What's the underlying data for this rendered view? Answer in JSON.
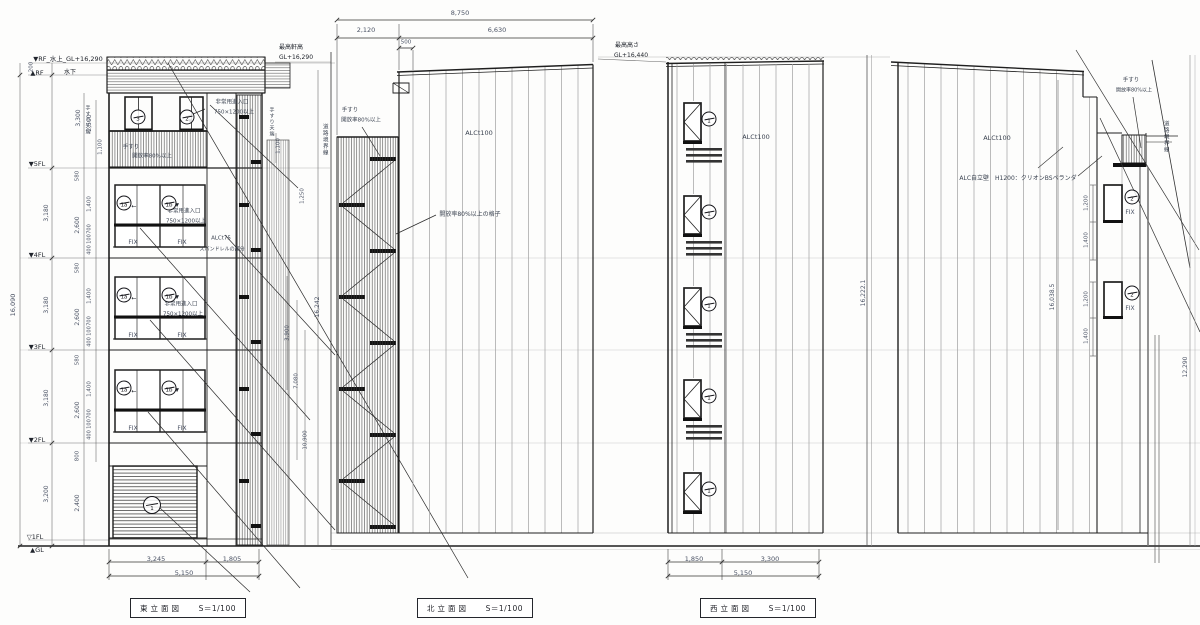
{
  "palette": {
    "line": "#1f1f1f",
    "dim": "#4a5264",
    "note": "#3a4250",
    "label": "#20242c"
  },
  "titles": {
    "east": {
      "name": "東立面図",
      "scale": "S＝1/100"
    },
    "north": {
      "name": "北立面図",
      "scale": "S＝1/100"
    },
    "west": {
      "name": "西立面図",
      "scale": "S＝1/100"
    }
  },
  "window_marks": [
    {
      "x": 138,
      "y": 117,
      "t": "3"
    },
    {
      "x": 187,
      "y": 117,
      "t": "2"
    },
    {
      "x": 124,
      "y": 203,
      "t": "1a"
    },
    {
      "x": 169,
      "y": 203,
      "t": "1b"
    },
    {
      "x": 124,
      "y": 295,
      "t": "1a"
    },
    {
      "x": 169,
      "y": 295,
      "t": "1b"
    },
    {
      "x": 124,
      "y": 388,
      "t": "1a"
    },
    {
      "x": 169,
      "y": 388,
      "t": "1b"
    },
    {
      "x": 152,
      "y": 505,
      "t": "1",
      "d": 18
    },
    {
      "x": 709,
      "y": 119,
      "t": "1"
    },
    {
      "x": 709,
      "y": 212,
      "t": "1"
    },
    {
      "x": 709,
      "y": 304,
      "t": "1"
    },
    {
      "x": 709,
      "y": 396,
      "t": "1"
    },
    {
      "x": 709,
      "y": 489,
      "t": "1"
    },
    {
      "x": 1132,
      "y": 197,
      "t": "2"
    },
    {
      "x": 1132,
      "y": 293,
      "t": "2"
    }
  ],
  "annotations": [
    {
      "n": "level-rf-top",
      "x": 68,
      "y": 59,
      "t": "▼RF_水上_GL+16,290",
      "s": 6.5,
      "c": "label"
    },
    {
      "n": "level-rf",
      "x": 37,
      "y": 73,
      "t": "▲RF",
      "s": 6.5,
      "c": "label"
    },
    {
      "n": "level-rf-lower",
      "x": 70,
      "y": 73,
      "t": "水下",
      "s": 6,
      "c": "label"
    },
    {
      "n": "level-5fl",
      "x": 37,
      "y": 164,
      "t": "▼5FL",
      "s": 6.5,
      "c": "label"
    },
    {
      "n": "level-4fl",
      "x": 37,
      "y": 255,
      "t": "▼4FL",
      "s": 6.5,
      "c": "label"
    },
    {
      "n": "level-3fl",
      "x": 37,
      "y": 347,
      "t": "▼3FL",
      "s": 6.5,
      "c": "label"
    },
    {
      "n": "level-2fl",
      "x": 37,
      "y": 440,
      "t": "▼2FL",
      "s": 6.5,
      "c": "label"
    },
    {
      "n": "level-1fl",
      "x": 35,
      "y": 537,
      "t": "▽1FL",
      "s": 6.5,
      "c": "label"
    },
    {
      "n": "level-gl",
      "x": 37,
      "y": 550,
      "t": "▲GL",
      "s": 6.5,
      "c": "label"
    },
    {
      "n": "east-overall-height",
      "x": 13,
      "y": 305,
      "t": "16,090",
      "m": "r",
      "s": 6.5
    },
    {
      "x": 32,
      "y": 67,
      "t": "200",
      "m": "r",
      "s": 5.5
    },
    {
      "x": 79,
      "y": 118,
      "t": "3,300",
      "m": "r",
      "s": 6
    },
    {
      "x": 90,
      "y": 123,
      "t": "2,500",
      "m": "r",
      "s": 6
    },
    {
      "x": 101,
      "y": 147,
      "t": "1,100",
      "m": "r",
      "s": 5.5
    },
    {
      "x": 78,
      "y": 176,
      "t": "580",
      "m": "r",
      "s": 5.5
    },
    {
      "x": 47,
      "y": 213,
      "t": "3,180",
      "m": "r",
      "s": 6
    },
    {
      "x": 78,
      "y": 225,
      "t": "2,600",
      "m": "r",
      "s": 6
    },
    {
      "x": 90,
      "y": 204,
      "t": "1,400",
      "m": "r",
      "s": 5.5
    },
    {
      "x": 90,
      "y": 229,
      "t": "700",
      "m": "r",
      "s": 5
    },
    {
      "x": 90,
      "y": 239,
      "t": "100",
      "m": "r",
      "s": 5
    },
    {
      "x": 90,
      "y": 250,
      "t": "400",
      "m": "r",
      "s": 5
    },
    {
      "x": 78,
      "y": 268,
      "t": "580",
      "m": "r",
      "s": 5.5
    },
    {
      "x": 47,
      "y": 305,
      "t": "3,180",
      "m": "r",
      "s": 6
    },
    {
      "x": 78,
      "y": 317,
      "t": "2,600",
      "m": "r",
      "s": 6
    },
    {
      "x": 90,
      "y": 296,
      "t": "1,400",
      "m": "r",
      "s": 5.5
    },
    {
      "x": 90,
      "y": 321,
      "t": "700",
      "m": "r",
      "s": 5
    },
    {
      "x": 90,
      "y": 331,
      "t": "100",
      "m": "r",
      "s": 5
    },
    {
      "x": 90,
      "y": 342,
      "t": "400",
      "m": "r",
      "s": 5
    },
    {
      "x": 78,
      "y": 360,
      "t": "580",
      "m": "r",
      "s": 5.5
    },
    {
      "x": 47,
      "y": 398,
      "t": "3,180",
      "m": "r",
      "s": 6
    },
    {
      "x": 78,
      "y": 410,
      "t": "2,600",
      "m": "r",
      "s": 6
    },
    {
      "x": 90,
      "y": 389,
      "t": "1,400",
      "m": "r",
      "s": 5.5
    },
    {
      "x": 90,
      "y": 414,
      "t": "700",
      "m": "r",
      "s": 5
    },
    {
      "x": 90,
      "y": 424,
      "t": "100",
      "m": "r",
      "s": 5
    },
    {
      "x": 90,
      "y": 435,
      "t": "400",
      "m": "r",
      "s": 5
    },
    {
      "x": 78,
      "y": 456,
      "t": "800",
      "m": "r",
      "s": 5.5
    },
    {
      "x": 47,
      "y": 494,
      "t": "3,200",
      "m": "r",
      "s": 6
    },
    {
      "x": 78,
      "y": 503,
      "t": "2,400",
      "m": "r",
      "s": 6
    },
    {
      "n": "fix-label",
      "x": 133,
      "y": 243,
      "t": "FIX",
      "s": 6
    },
    {
      "n": "fix-label",
      "x": 182,
      "y": 243,
      "t": "FIX",
      "s": 6
    },
    {
      "n": "fix-label",
      "x": 133,
      "y": 336,
      "t": "FIX",
      "s": 6
    },
    {
      "n": "fix-label",
      "x": 182,
      "y": 336,
      "t": "FIX",
      "s": 6
    },
    {
      "n": "fix-label",
      "x": 133,
      "y": 429,
      "t": "FIX",
      "s": 6
    },
    {
      "n": "fix-label",
      "x": 182,
      "y": 429,
      "t": "FIX",
      "s": 6
    },
    {
      "x": 232,
      "y": 103,
      "t": "非常用進入口",
      "s": 5.5,
      "c": "note"
    },
    {
      "x": 234,
      "y": 113,
      "t": "750×1200以上",
      "s": 5.5,
      "c": "note"
    },
    {
      "x": 184,
      "y": 212,
      "t": "非常用進入口",
      "s": 5.5,
      "c": "note"
    },
    {
      "x": 186,
      "y": 222,
      "t": "750×1200以上",
      "s": 5.5,
      "c": "note"
    },
    {
      "x": 181,
      "y": 305,
      "t": "非常用進入口",
      "s": 5.5,
      "c": "note"
    },
    {
      "x": 183,
      "y": 315,
      "t": "750×1200以上",
      "s": 5.5,
      "c": "note"
    },
    {
      "x": 131,
      "y": 148,
      "t": "手すり",
      "s": 5.5,
      "c": "note"
    },
    {
      "x": 152,
      "y": 157,
      "t": "開放率80%以上",
      "s": 5.5,
      "c": "note"
    },
    {
      "x": 87,
      "y": 120,
      "t": "手すり天端",
      "m": "v",
      "s": 5,
      "c": "note"
    },
    {
      "x": 271,
      "y": 122,
      "t": "手すり天端",
      "m": "v",
      "s": 5,
      "c": "note"
    },
    {
      "x": 279,
      "y": 146,
      "t": "1,100",
      "m": "r",
      "s": 5.5
    },
    {
      "x": 221,
      "y": 239,
      "t": "ALCt75",
      "s": 5.5,
      "c": "note"
    },
    {
      "x": 222,
      "y": 250,
      "t": "スパンドレルの部分",
      "s": 5,
      "c": "note"
    },
    {
      "x": 303,
      "y": 196,
      "t": "1,250",
      "m": "r",
      "s": 5.5
    },
    {
      "x": 318,
      "y": 307,
      "t": "16,242",
      "m": "r",
      "s": 6
    },
    {
      "x": 288,
      "y": 333,
      "t": "3,900",
      "m": "r",
      "s": 5.5
    },
    {
      "x": 297,
      "y": 381,
      "t": "7,080",
      "m": "r",
      "s": 5.5
    },
    {
      "x": 306,
      "y": 440,
      "t": "10,900",
      "m": "r",
      "s": 5.5
    },
    {
      "n": "north-eave-height",
      "x": 291,
      "y": 48,
      "t": "最高軒高",
      "s": 6,
      "c": "label"
    },
    {
      "n": "north-eave-height-value",
      "x": 296,
      "y": 58,
      "t": "GL+16,290",
      "s": 6,
      "c": "label"
    },
    {
      "x": 156,
      "y": 559,
      "t": "3,245",
      "s": 6.5
    },
    {
      "x": 232,
      "y": 559,
      "t": "1,805",
      "s": 6.5
    },
    {
      "x": 184,
      "y": 573,
      "t": "5,150",
      "s": 6.5
    },
    {
      "x": 190,
      "y": 122,
      "t": "▼",
      "s": 5,
      "c": "label"
    },
    {
      "x": 177,
      "y": 206,
      "t": "▼",
      "s": 5,
      "c": "label"
    },
    {
      "x": 177,
      "y": 298,
      "t": "▼",
      "s": 5,
      "c": "label"
    },
    {
      "x": 177,
      "y": 391,
      "t": "▼",
      "s": 5,
      "c": "label"
    },
    {
      "x": 134,
      "y": 207,
      "t": "←",
      "s": 6,
      "c": "label"
    },
    {
      "x": 134,
      "y": 299,
      "t": "←",
      "s": 6,
      "c": "label"
    },
    {
      "x": 134,
      "y": 392,
      "t": "←",
      "s": 6,
      "c": "label"
    },
    {
      "x": 460,
      "y": 13,
      "t": "8,750",
      "s": 6.5
    },
    {
      "x": 366,
      "y": 30,
      "t": "2,120",
      "s": 6.5
    },
    {
      "x": 497,
      "y": 30,
      "t": "6,630",
      "s": 6.5
    },
    {
      "x": 406,
      "y": 43,
      "t": "500",
      "s": 5.5
    },
    {
      "x": 350,
      "y": 111,
      "t": "手すり",
      "s": 5.5,
      "c": "note"
    },
    {
      "x": 361,
      "y": 121,
      "t": "開放率80%以上",
      "s": 5.5,
      "c": "note"
    },
    {
      "x": 470,
      "y": 215,
      "t": "開放率80%以上の格子",
      "s": 6,
      "c": "note"
    },
    {
      "n": "north-wall-material",
      "x": 479,
      "y": 133,
      "t": "ALCt100",
      "s": 6.5,
      "c": "note"
    },
    {
      "n": "north-road-boundary",
      "x": 324,
      "y": 140,
      "t": "道路境界線",
      "m": "v",
      "s": 5.5,
      "c": "note"
    },
    {
      "n": "west-max-height",
      "x": 627,
      "y": 46,
      "t": "最高高さ",
      "s": 6,
      "c": "label"
    },
    {
      "n": "west-max-height-value",
      "x": 631,
      "y": 56,
      "t": "GL+16,440",
      "s": 6,
      "c": "label"
    },
    {
      "n": "west-wall-material",
      "x": 756,
      "y": 137,
      "t": "ALCt100",
      "s": 6.5,
      "c": "note"
    },
    {
      "x": 864,
      "y": 293,
      "t": "16,222.1",
      "m": "r",
      "s": 6
    },
    {
      "x": 694,
      "y": 559,
      "t": "1,850",
      "s": 6.5
    },
    {
      "x": 770,
      "y": 559,
      "t": "3,300",
      "s": 6.5
    },
    {
      "x": 743,
      "y": 573,
      "t": "5,150",
      "s": 6.5
    },
    {
      "n": "south-wall-material",
      "x": 997,
      "y": 138,
      "t": "ALCt100",
      "s": 6.5,
      "c": "note"
    },
    {
      "x": 1131,
      "y": 81,
      "t": "手すり",
      "s": 5.5,
      "c": "note"
    },
    {
      "x": 1134,
      "y": 91,
      "t": "開放率80%以上",
      "s": 5,
      "c": "note"
    },
    {
      "n": "alc-freestanding-wall",
      "x": 1018,
      "y": 179,
      "t": "ALC自立壁　H1200：クリオンBSベランダ",
      "s": 6,
      "c": "note"
    },
    {
      "n": "south-road-boundary",
      "x": 1165,
      "y": 137,
      "t": "道路境界線",
      "m": "v",
      "s": 5.5,
      "c": "note"
    },
    {
      "n": "fix-label",
      "x": 1130,
      "y": 213,
      "t": "FIX",
      "s": 6
    },
    {
      "n": "fix-label",
      "x": 1130,
      "y": 309,
      "t": "FIX",
      "s": 6
    },
    {
      "x": 1087,
      "y": 203,
      "t": "1,200",
      "m": "r",
      "s": 5.5
    },
    {
      "x": 1087,
      "y": 240,
      "t": "1,400",
      "m": "r",
      "s": 5.5
    },
    {
      "x": 1087,
      "y": 299,
      "t": "1,200",
      "m": "r",
      "s": 5.5
    },
    {
      "x": 1087,
      "y": 336,
      "t": "1,400",
      "m": "r",
      "s": 5.5
    },
    {
      "x": 1053,
      "y": 297,
      "t": "16,038.5",
      "m": "r",
      "s": 6
    },
    {
      "x": 1186,
      "y": 367,
      "t": "12,290",
      "m": "r",
      "s": 6
    }
  ]
}
